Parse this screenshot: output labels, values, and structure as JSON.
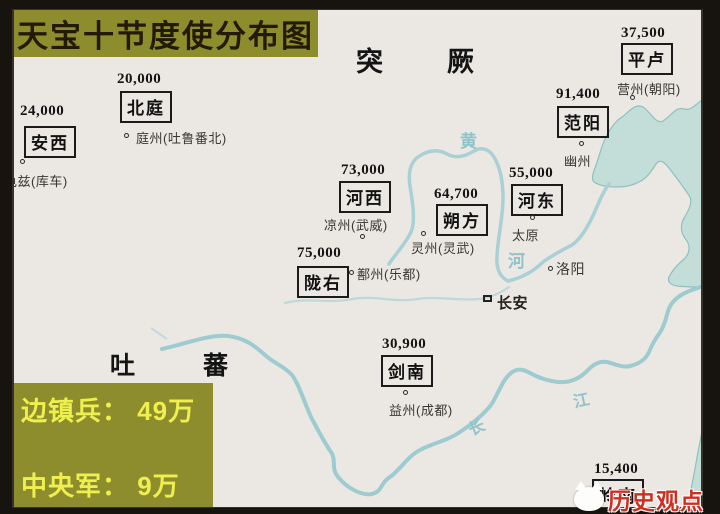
{
  "title": "天宝十节度使分布图",
  "neighbors": [
    {
      "name": "突厥"
    },
    {
      "name": "吐蕃"
    }
  ],
  "garrisons": [
    {
      "name": "安西",
      "troops": "24,000",
      "city": "龟兹(库车)"
    },
    {
      "name": "北庭",
      "troops": "20,000",
      "city": "庭州(吐鲁番北)"
    },
    {
      "name": "平卢",
      "troops": "37,500",
      "city": "营州(朝阳)"
    },
    {
      "name": "范阳",
      "troops": "91,400",
      "city": "幽州"
    },
    {
      "name": "河西",
      "troops": "73,000",
      "city": "凉州(武威)"
    },
    {
      "name": "朔方",
      "troops": "64,700",
      "city": "灵州(灵武)"
    },
    {
      "name": "河东",
      "troops": "55,000",
      "city": "太原"
    },
    {
      "name": "陇右",
      "troops": "75,000",
      "city": "鄯州(乐都)"
    },
    {
      "name": "剑南",
      "troops": "30,900",
      "city": "益州(成都)"
    },
    {
      "name": "岭南",
      "troops": "15,400",
      "city": ""
    }
  ],
  "capitals": [
    {
      "name": "长安",
      "marker": "square"
    },
    {
      "name": "洛阳",
      "marker": "circle"
    }
  ],
  "rivers": [
    {
      "name": "黄河",
      "chars": [
        "黄",
        "河"
      ]
    },
    {
      "name": "长江",
      "chars": [
        "长",
        "江"
      ]
    }
  ],
  "legend": {
    "line1": "边镇兵： 49万",
    "line2": "中央军： 9万"
  },
  "watermark": {
    "text": "历史观点",
    "logo": "cat-logo"
  },
  "colors": {
    "border-dark": "#17140f",
    "paper": "#ebe8e4",
    "olive": "#8d8d2d",
    "legend-text": "#eff04e",
    "title-text": "#231a06",
    "sea": "#c3ded9",
    "coast": "#8fc0bb",
    "river": "#a9d0d4",
    "ink": "#1c1c1c",
    "watermark-red": "#cf2f22"
  }
}
